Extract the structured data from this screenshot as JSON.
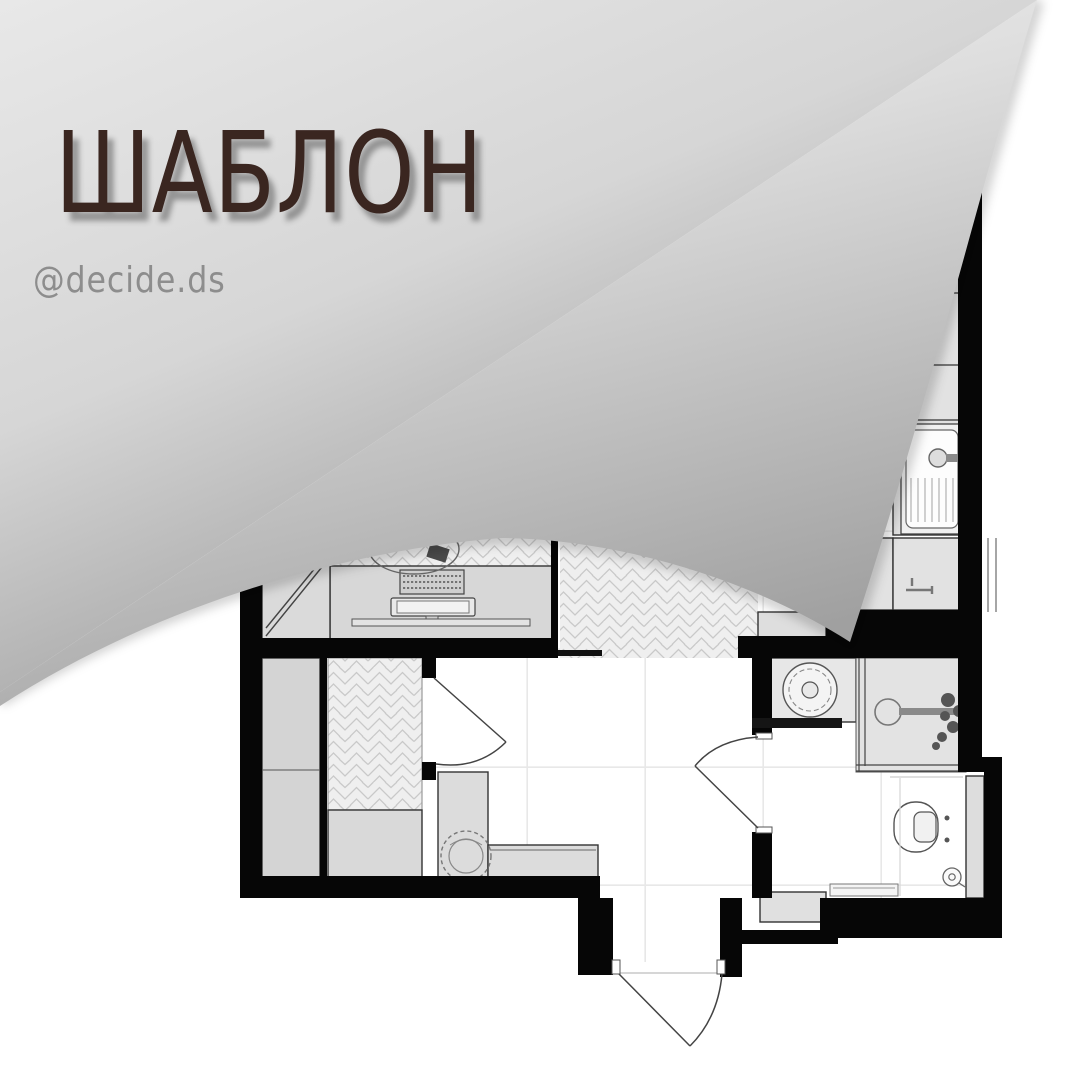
{
  "post": {
    "title": "ШАБЛОН",
    "handle": "@decide.ds"
  },
  "colors": {
    "title-color": "#3a2620",
    "handle-color": "#8d8d8d",
    "wall": "#060606",
    "furniture-fill": "#d7d7d7",
    "furniture-stroke": "#333333",
    "herringbone-bg": "#efefef",
    "herringbone-line": "#c9c9c9",
    "tile-line": "#e2e2e2",
    "curl-light": "#e8e8e8",
    "curl-dark": "#8d8d8d",
    "under-light": "#f4f4f4",
    "under-dark": "#a0a0a0"
  },
  "plan": {
    "type": "studio-apartment-floor-plan",
    "fixtures": [
      "wardrobe",
      "fridge",
      "desk",
      "office-chair",
      "keyboard",
      "monitor",
      "shelf",
      "herringbone-floor",
      "plant",
      "bench",
      "side-cabinet",
      "kitchen-cabinets",
      "kitchen-sink",
      "kitchen-faucet",
      "hob",
      "washing-machine",
      "bathroom-sink",
      "shower",
      "shower-mixer",
      "toilet",
      "floor-drain",
      "bath-mat",
      "entry-cabinet",
      "duct-shaft",
      "entrance-door",
      "bathroom-door",
      "balcony-door"
    ]
  }
}
